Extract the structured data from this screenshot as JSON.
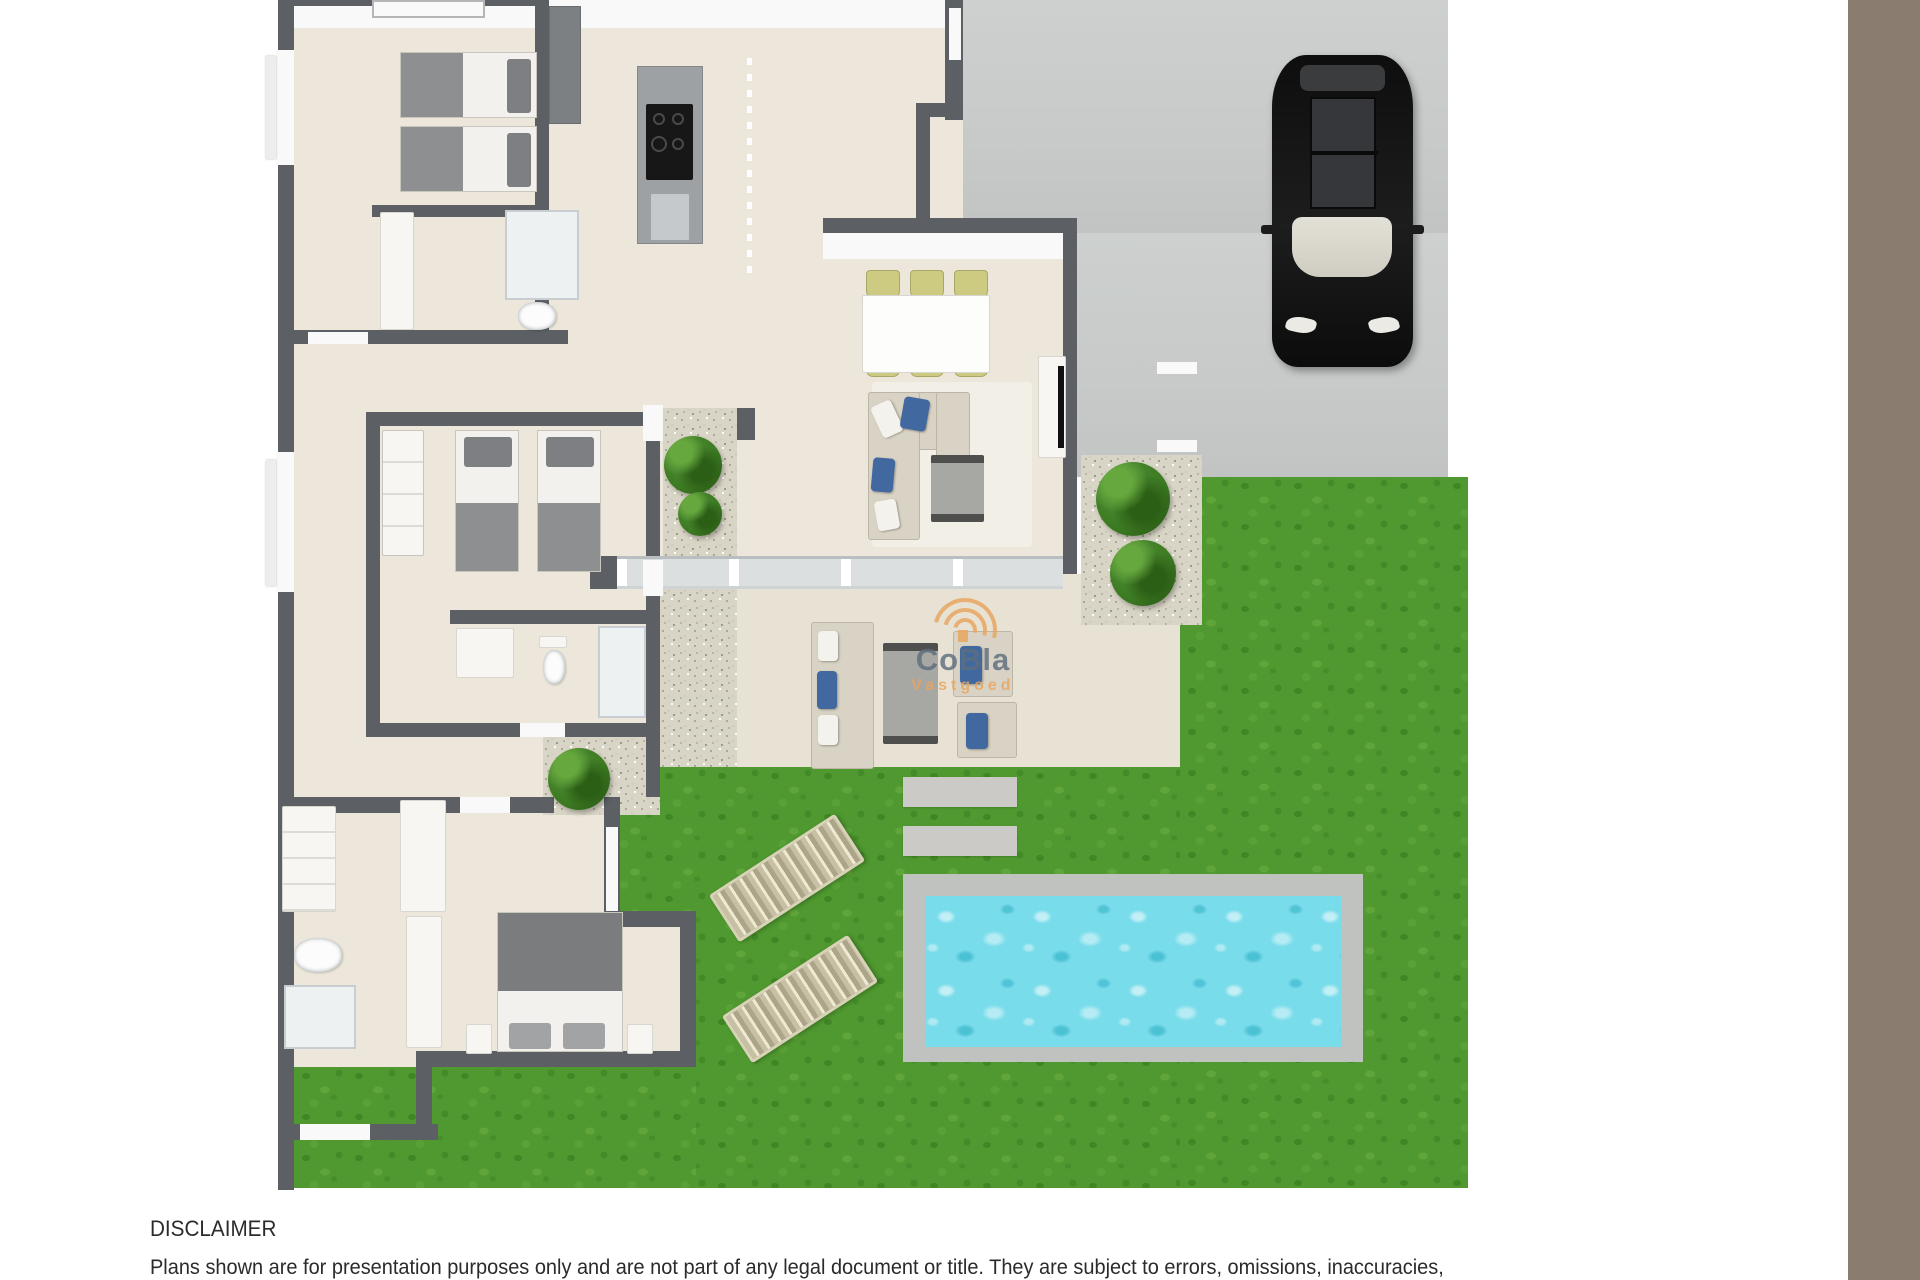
{
  "watermark": {
    "brand": "CoBla",
    "subtitle": "Vastgoed"
  },
  "disclaimer": {
    "title": "DISCLAIMER",
    "body": "Plans shown are for presentation purposes only and are not part of any legal document or title. They are subject to errors, omissions, inaccuracies,"
  },
  "plan_features": [
    "floor-plan",
    "lawn",
    "driveway",
    "car",
    "swimming-pool",
    "sun-loungers",
    "patio",
    "bedrooms",
    "bathrooms",
    "kitchen-island",
    "dining-table",
    "sofas",
    "bushes"
  ],
  "colors": {
    "wall": "#5c6064",
    "floor": "#ece7da",
    "patio": "#e7e2d4",
    "grass": "#4f9930",
    "driveway": "#c7cac9",
    "gravel": "#d9d5c6",
    "pool_deck": "#bfc2bf",
    "pool_water": "#79dcea",
    "bush": "#3c7a22",
    "furniture": "#d9d3c5",
    "pillow_blue": "#4169a0",
    "chair_olive": "#cdcb82",
    "bed_gray": "#8e8f91",
    "car": "#161616",
    "watermark_orange": "#e9a55e",
    "watermark_gray": "#5e6d7d",
    "margin_strip": "#8a7c6e",
    "text": "#2b2b2b"
  }
}
